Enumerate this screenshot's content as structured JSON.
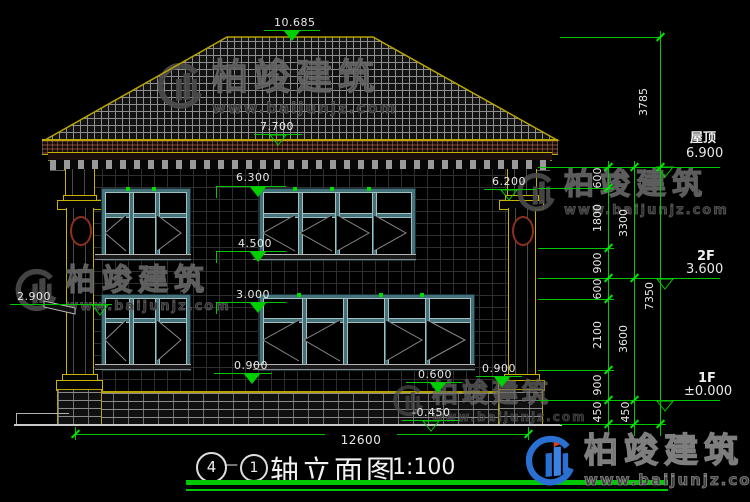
{
  "drawing": {
    "type": "architectural-elevation",
    "scale_ratio": "1:100"
  },
  "title": {
    "bubble_left": "4",
    "separator": "—",
    "bubble_right": "1",
    "text": "轴立面图",
    "scale": "1:100"
  },
  "levels": {
    "peak": "10.685",
    "eave": "7.700",
    "ledge_left": "2.900",
    "win2_head": "6.300",
    "win2_sill": "4.500",
    "win1_head": "3.000",
    "win1_sill": "0.900",
    "capital_right": "6.200",
    "plinth_top": "0.600",
    "pedestal_top": "0.900",
    "ground": "-0.450",
    "roof": {
      "label": "屋顶",
      "value": "6.900"
    },
    "floor2": {
      "label": "2F",
      "value": "3.600"
    },
    "floor1": {
      "label": "1F",
      "value": "±0.000"
    }
  },
  "dims": {
    "roof_height": "3785",
    "chain_a": [
      "600",
      "1800",
      "900",
      "600",
      "2100",
      "900",
      "450"
    ],
    "chain_b": [
      "3300",
      "3600",
      "450"
    ],
    "total_height": "7350",
    "total_width": "12600"
  },
  "watermark": {
    "brand": "柏竣建筑",
    "url": "www.baijunjz.com"
  },
  "icons": {
    "logo": "baijun-building-logo",
    "marker": "elevation-triangle"
  },
  "colors": {
    "background": "#000000",
    "dimension_green": "#00c800",
    "outline_yellow": "#b8a400",
    "window_teal": "#44717a",
    "fascia_maroon": "#20100c",
    "text_white": "#e8e8e8",
    "watermark_gray": "#3f3f3f",
    "brand_blue": "#2a70d2"
  }
}
